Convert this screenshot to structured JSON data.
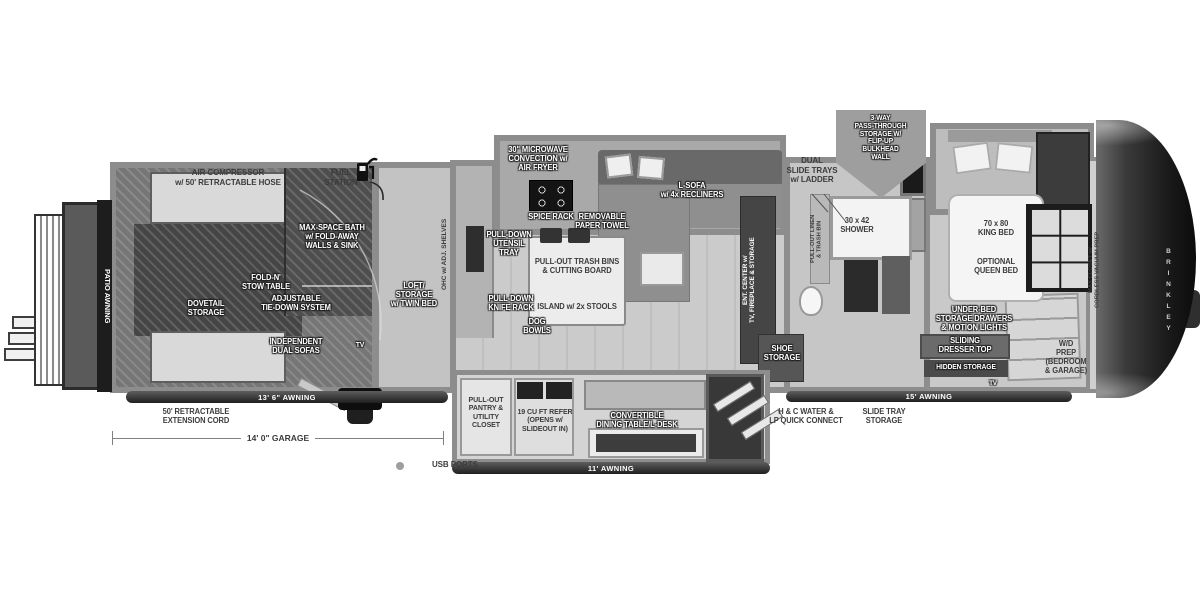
{
  "colors": {
    "bg": "#ffffff",
    "wall": "#8d8d8d",
    "floor_light": "#c9c9c9",
    "floor_dark": "#767676",
    "dark_zone": "#4a4a4a",
    "badge": "#9e9e9e",
    "text_dark": "#3c3c3c",
    "cap": "#1c1c1c"
  },
  "exterior": {
    "air_compressor": "AIR COMPRESSOR\nw/ 50' RETRACTABLE HOSE",
    "fuel_station": "FUEL\nSTATION",
    "pass_through_badge": "3-WAY\nPASS-THROUGH\nSTORAGE W/\nFLIP-UP\nBULKHEAD\nWALL",
    "dual_slide_trays": "DUAL\nSLIDE TRAYS\nw/ LADDER",
    "patio_awning": "PATIO AWNING",
    "brand_vertical": "BRINKLEY"
  },
  "garage": {
    "max_space_bath": "MAX-SPACE BATH\nw/ FOLD-AWAY\nWALLS & SINK",
    "fold_n_stow_table": "FOLD-N'\nSTOW TABLE",
    "dovetail_storage": "DOVETAIL\nSTORAGE",
    "adjustable_tie_down": "ADJUSTABLE\nTIE-DOWN SYSTEM",
    "independent_dual_sofas": "INDEPENDENT\nDUAL SOFAS",
    "tv": "TV",
    "loft_storage": "LOFT/\nSTORAGE\nw/ TWIN BED",
    "ohc_shelves": "OHC w/ ADJ. SHELVES"
  },
  "kitchen": {
    "microwave": "30\" MICROWAVE\nCONVECTION w/\nAIR FRYER",
    "spice_rack": "SPICE RACK",
    "paper_towel": "REMOVABLE\nPAPER TOWEL",
    "utensil_tray": "PULL-DOWN\nUTENSIL\nTRAY",
    "trash_bins": "PULL-OUT TRASH BINS\n& CUTTING BOARD",
    "island": "ISLAND w/ 2x STOOLS",
    "knife_rack": "PULL-DOWN\nKNIFE RACK",
    "dog_bowls": "DOG\nBOWLS"
  },
  "living": {
    "l_sofa": "L-SOFA\nw/ 4x RECLINERS",
    "ent_center": "ENT. CENTER w/\nTV, FIREPLACE & STORAGE",
    "shoe_storage": "SHOE\nSTORAGE"
  },
  "bath": {
    "shower": "30 x 42\nSHOWER",
    "linen": "PULL-OUT LINEN\n& TRASH BIN"
  },
  "bedroom": {
    "king_bed": "70 x 80\nKING BED",
    "queen_bed": "OPTIONAL\nQUEEN BED",
    "under_bed": "UNDER-BED\nSTORAGE DRAWERS\n& MOTION LIGHTS",
    "sliding_dresser": "SLIDING\nDRESSER TOP",
    "hidden_storage": "HIDDEN STORAGE",
    "wd_prep": "W/D\nPREP\n(BEDROOM\n& GARAGE)",
    "closet": "MAX CLOSET w/\nCORDLESS VACUUM PREP",
    "tv": "TV"
  },
  "bottom": {
    "awning_garage": "13' 6\" AWNING",
    "extension_cord": "50' RETRACTABLE\nEXTENSION CORD",
    "garage_dim": "14' 0\" GARAGE",
    "usb_ports": "USB PORTS",
    "pantry": "PULL-OUT\nPANTRY &\nUTILITY\nCLOSET",
    "refer": "19 CU FT REFER\n(OPENS w/\nSLIDEOUT IN)",
    "dining": "CONVERTIBLE\nDINING TABLE/L-DESK",
    "awning_main": "11' AWNING",
    "awning_bedroom": "15' AWNING",
    "hc_water": "H & C WATER &\nLP QUICK CONNECT",
    "slide_tray": "SLIDE TRAY\nSTORAGE"
  }
}
